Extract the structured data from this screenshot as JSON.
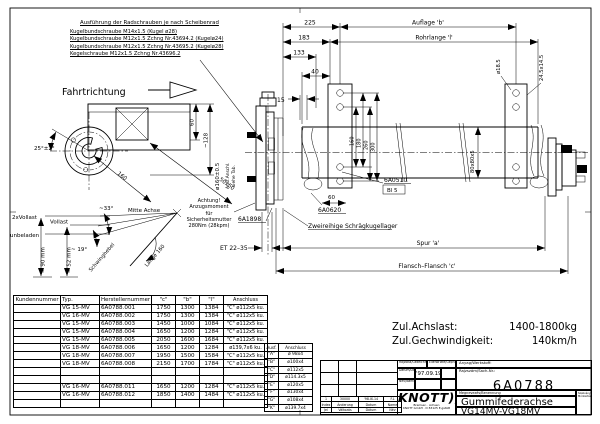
{
  "notes": {
    "title": "Ausführung der Radschrauben je nach Scheibenrad",
    "lines": [
      "Kugelbundschraube M14x1.5 (Kugel ø28)",
      "Kugelbundschraube M12x1.5 Zchng Nr.43694.2 (Kugelø24)",
      "Kugelbundschraube M12x1.5 Zchng Nr.43695.2 (Kugelø28)",
      "Kegelschraube M12x1.5 Zchng Nr.43696.2"
    ],
    "achtung_lines": [
      "Achtung!",
      "Anzugsmoment",
      "für",
      "Sicherheitsmutter",
      "280Nm (28kpm)"
    ],
    "fahrtrichtung": "Fahrtrichtung"
  },
  "dims": {
    "d225": "225",
    "auflage_b": "Auflage 'b'",
    "d183": "183",
    "rohrlange_l": "Rohrlange 'l'",
    "d133": "133",
    "d40": "40",
    "d15": "15",
    "d160": "160",
    "d180": "180",
    "d260": "260",
    "d300": "300",
    "dia18_5": "ø18.5",
    "slot24": "24.5x14.5",
    "tube80": "80x80x5",
    "spur_a": "Spur 'a'",
    "flansch_c": "Flansch–Flansch 'c'",
    "et": "ET 22–35",
    "d60": "60",
    "d128": "~128",
    "d160diag": "160",
    "d50": "50x50",
    "ang25": "25°±2°",
    "dia160": "ø160±0.5",
    "ausf_ref1": "Ausf.Anschl.",
    "ausf_ref2": "siehe Tab.",
    "ang33": "~33°",
    "ang19": "~ 19°",
    "h90": "≈ 90 mm",
    "h52": "≈ 52 mm",
    "mitte_achse": "Mitte Achse",
    "vollast2": "2xVollast",
    "vollast": "Vollast",
    "unbeladen": "unbeladen",
    "schwinghebel": "Schwinghebel",
    "laenge160": "Länge 160",
    "d60b": "60"
  },
  "parts": {
    "p1": "6A1898",
    "p2": "6A0620",
    "p3": "6A0510",
    "bl": "Bl 5",
    "lager": "Zweireihige Schrägkugellager"
  },
  "main_table": {
    "headers": [
      "Kundennummer",
      "Typ.",
      "Herstellernummer",
      "\"c\"",
      "\"b\"",
      "\"l\"",
      "Anschluss"
    ],
    "rows": [
      [
        "",
        "VG 15-MV",
        "6A0788.001",
        "1750",
        "1300",
        "1384",
        "\"C\" ø112x5 ku."
      ],
      [
        "",
        "VG 16-MV",
        "6A0788.002",
        "1750",
        "1300",
        "1384",
        "\"C\" ø112x5 ku."
      ],
      [
        "",
        "VG 15-MV",
        "6A0788.003",
        "1450",
        "1000",
        "1084",
        "\"C\" ø112x5 ku."
      ],
      [
        "",
        "VG 15-MV",
        "6A0788.004",
        "1650",
        "1200",
        "1284",
        "\"C\" ø112x5 ku."
      ],
      [
        "",
        "VG 15-MV",
        "6A0788.005",
        "2050",
        "1600",
        "1684",
        "\"C\" ø112x5 ku."
      ],
      [
        "",
        "VG 18-MV",
        "6A0788.006",
        "1650",
        "1200",
        "1284",
        "ø139,7x6 ku."
      ],
      [
        "",
        "VG 18-MV",
        "6A0788.007",
        "1950",
        "1500",
        "1584",
        "\"C\" ø112x5 ku."
      ],
      [
        "",
        "VG 18-MV",
        "6A0788.008",
        "2150",
        "1700",
        "1784",
        "\"C\" ø112x5 ku."
      ],
      [
        "",
        "",
        "",
        "",
        "",
        "",
        ""
      ],
      [
        "",
        "",
        "",
        "",
        "",
        "",
        ""
      ],
      [
        "",
        "VG 16-MV",
        "6A0788.011",
        "1650",
        "1200",
        "1284",
        "\"C\" ø112x5 ku."
      ],
      [
        "",
        "VG 16-MV",
        "6A0788.012",
        "1850",
        "1400",
        "1484",
        "\"C\" ø112x5 ku."
      ],
      [
        "",
        "",
        "",
        "",
        "",
        "",
        ""
      ]
    ]
  },
  "ausf_table": {
    "headers": [
      "Ausf.",
      "Anschluss"
    ],
    "rows": [
      [
        "\"A\"",
        "ø 98x4"
      ],
      [
        "\"B\"",
        "ø100x4"
      ],
      [
        "\"C\"",
        "ø112x5"
      ],
      [
        "\"D\"",
        "ø114.3x5"
      ],
      [
        "\"E\"",
        "ø120x5"
      ],
      [
        "\"F\"",
        "ø130x4"
      ],
      [
        "\"G\"",
        "ø108x4"
      ],
      [
        "\"K\"",
        "ø139.7x4"
      ]
    ]
  },
  "specs": {
    "achslast_label": "Zul.Achslast:",
    "achslast_value": "1400-1800kg",
    "speed_label": "Zul.Gechwindigkeit:",
    "speed_value": "140km/h"
  },
  "revision": {
    "rows": [
      [
        "1",
        "30000",
        "'98.IX.14",
        "F.L"
      ],
      [
        "Index",
        "Änderung",
        "Datum",
        "Name"
      ],
      [
        "Jel",
        "Változás",
        "Dátum",
        "Név"
      ]
    ]
  },
  "title_block": {
    "drawn_label": "Rajzolta/Gezeichnet",
    "checked_label": "Ellenőrizte/Geprüft",
    "material_label": "Anyag/Werkstoff:",
    "date_label": "Dátum/Date",
    "date_value": "'97.09.19",
    "name_label": "Név/Name",
    "number_label": "Rajzszám/Sach-Nr.:",
    "number_value": "6A0788",
    "designation_label": "Megnevezés/Benennung",
    "designation_value": "Gummifederachse",
    "type_range": "VG14MV-VG18MV",
    "brand": "KNOTT",
    "brand_arcs": ")))",
    "brand_line1": "Bremsen · Achsen",
    "brand_line2": "KNOTT GmbH · D 83125 E,gstätt",
    "side_label1": "Szabványosítás",
    "side_label2": "Módosítás"
  }
}
